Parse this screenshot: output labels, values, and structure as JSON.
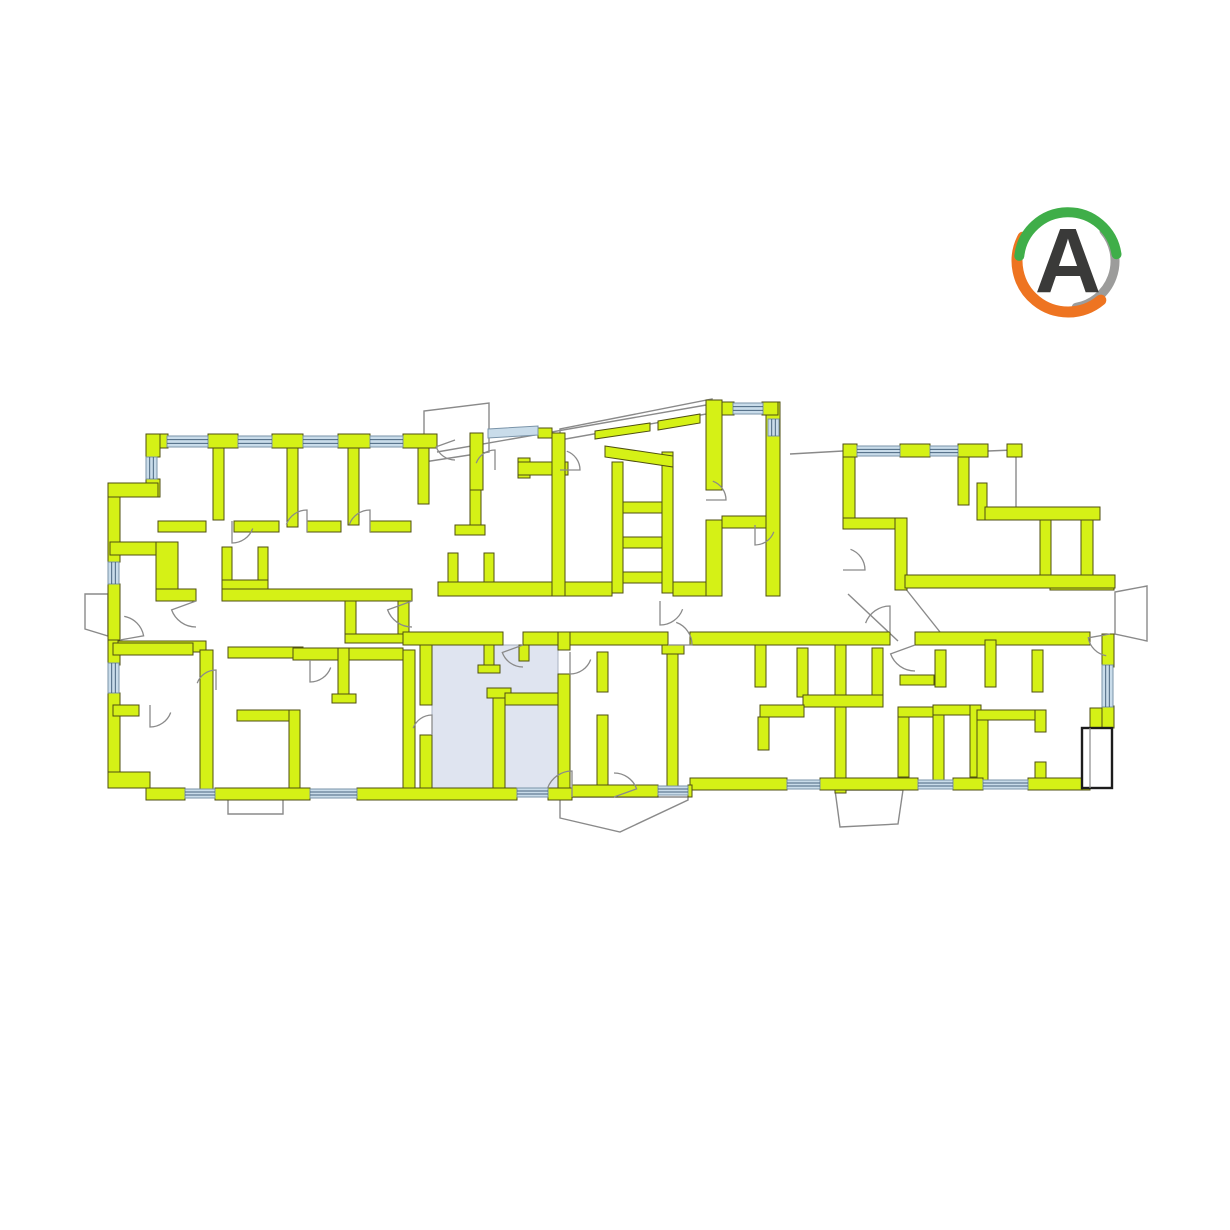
{
  "meta": {
    "background": "#ffffff",
    "width": 1230,
    "height": 1230
  },
  "logo": {
    "letter": "A",
    "letter_color": "#3a3a39",
    "cx": 1068,
    "cy": 261,
    "arcs": [
      {
        "start": -40,
        "end": 80,
        "r": 47,
        "w": 9,
        "color": "#9c9c9b"
      },
      {
        "start": 50,
        "end": 208,
        "r": 51,
        "w": 11,
        "color": "#ee7421"
      },
      {
        "start": 186,
        "end": 352,
        "r": 49,
        "w": 10,
        "color": "#3fae49"
      }
    ]
  },
  "plan": {
    "colors": {
      "wall_fill": "#d5f116",
      "wall_stroke": "#4f4f12",
      "window_fill": "#c9dcea",
      "window_stroke": "#7a93a8",
      "window_line": "#49657e",
      "outline_stroke": "#8a8a8a",
      "door_stroke": "#8a8a8a",
      "highlight_fill": "#dfe4f0",
      "highlight_stroke": "#aab2c2",
      "balcony_stroke": "#1c1c1c"
    },
    "highlight_unit": {
      "rect": [
        432,
        645,
        126,
        143
      ],
      "selected": true
    },
    "balcony": {
      "rect": [
        1082,
        728,
        30,
        60
      ],
      "inner_line": [
        1090,
        728,
        1090,
        788
      ]
    },
    "walls": [
      [
        146,
        434,
        22,
        14
      ],
      [
        208,
        434,
        30,
        14
      ],
      [
        272,
        434,
        31,
        14
      ],
      [
        338,
        434,
        32,
        14
      ],
      [
        403,
        434,
        34,
        14
      ],
      [
        213,
        448,
        11,
        72
      ],
      [
        287,
        448,
        11,
        79
      ],
      [
        348,
        448,
        11,
        77
      ],
      [
        418,
        448,
        11,
        56
      ],
      [
        158,
        521,
        48,
        11
      ],
      [
        234,
        521,
        45,
        11
      ],
      [
        307,
        521,
        34,
        11
      ],
      [
        370,
        521,
        41,
        11
      ],
      [
        146,
        434,
        14,
        23
      ],
      [
        146,
        479,
        14,
        18
      ],
      [
        108,
        483,
        50,
        14
      ],
      [
        108,
        497,
        12,
        65
      ],
      [
        108,
        584,
        12,
        56
      ],
      [
        108,
        640,
        12,
        25
      ],
      [
        108,
        693,
        12,
        80
      ],
      [
        108,
        772,
        42,
        16
      ],
      [
        110,
        542,
        58,
        13
      ],
      [
        156,
        542,
        22,
        47
      ],
      [
        222,
        547,
        10,
        42
      ],
      [
        258,
        547,
        10,
        42
      ],
      [
        222,
        580,
        46,
        9
      ],
      [
        448,
        553,
        10,
        37
      ],
      [
        484,
        553,
        10,
        37
      ],
      [
        448,
        582,
        46,
        8
      ],
      [
        156,
        589,
        40,
        12
      ],
      [
        222,
        589,
        190,
        12
      ],
      [
        438,
        582,
        114,
        14
      ],
      [
        565,
        582,
        47,
        14
      ],
      [
        673,
        582,
        33,
        14
      ],
      [
        345,
        601,
        11,
        40
      ],
      [
        398,
        601,
        11,
        40
      ],
      [
        345,
        634,
        64,
        9
      ],
      [
        470,
        433,
        13,
        57
      ],
      [
        470,
        490,
        11,
        40
      ],
      [
        455,
        525,
        30,
        10
      ],
      [
        518,
        458,
        12,
        20
      ],
      [
        518,
        462,
        50,
        13
      ],
      [
        538,
        428,
        14,
        10
      ],
      [
        552,
        433,
        13,
        163
      ],
      [
        612,
        462,
        11,
        131
      ],
      [
        662,
        452,
        11,
        141
      ],
      [
        623,
        502,
        39,
        11
      ],
      [
        623,
        537,
        39,
        11
      ],
      [
        623,
        572,
        39,
        11
      ],
      [
        706,
        400,
        16,
        90
      ],
      [
        706,
        520,
        16,
        76
      ],
      [
        766,
        402,
        14,
        194
      ],
      [
        722,
        402,
        12,
        13
      ],
      [
        762,
        402,
        16,
        13
      ],
      [
        722,
        516,
        44,
        12
      ],
      [
        843,
        444,
        14,
        13
      ],
      [
        900,
        444,
        30,
        13
      ],
      [
        958,
        444,
        30,
        13
      ],
      [
        1007,
        444,
        15,
        13
      ],
      [
        843,
        457,
        12,
        68
      ],
      [
        843,
        518,
        57,
        11
      ],
      [
        895,
        518,
        12,
        72
      ],
      [
        958,
        457,
        11,
        48
      ],
      [
        977,
        483,
        10,
        37
      ],
      [
        985,
        507,
        115,
        13
      ],
      [
        1040,
        520,
        11,
        57
      ],
      [
        1081,
        520,
        12,
        58
      ],
      [
        1050,
        577,
        64,
        13
      ],
      [
        905,
        575,
        210,
        13
      ],
      [
        118,
        641,
        88,
        11
      ],
      [
        228,
        647,
        75,
        11
      ],
      [
        293,
        648,
        110,
        12
      ],
      [
        403,
        632,
        100,
        13
      ],
      [
        523,
        632,
        145,
        13
      ],
      [
        690,
        632,
        200,
        13
      ],
      [
        915,
        632,
        175,
        13
      ],
      [
        113,
        643,
        80,
        12
      ],
      [
        200,
        650,
        13,
        140
      ],
      [
        113,
        705,
        26,
        11
      ],
      [
        237,
        710,
        63,
        11
      ],
      [
        289,
        710,
        11,
        78
      ],
      [
        338,
        648,
        11,
        50
      ],
      [
        332,
        694,
        24,
        9
      ],
      [
        403,
        650,
        12,
        138
      ],
      [
        420,
        645,
        12,
        60
      ],
      [
        420,
        735,
        12,
        53
      ],
      [
        484,
        645,
        10,
        24
      ],
      [
        478,
        665,
        22,
        8
      ],
      [
        519,
        645,
        10,
        16
      ],
      [
        493,
        688,
        12,
        100
      ],
      [
        487,
        688,
        24,
        10
      ],
      [
        505,
        693,
        55,
        12
      ],
      [
        558,
        632,
        12,
        18
      ],
      [
        558,
        674,
        12,
        114
      ],
      [
        597,
        652,
        11,
        40
      ],
      [
        597,
        715,
        11,
        75
      ],
      [
        667,
        652,
        11,
        138
      ],
      [
        662,
        645,
        22,
        9
      ],
      [
        755,
        645,
        11,
        42
      ],
      [
        797,
        648,
        11,
        49
      ],
      [
        835,
        645,
        11,
        148
      ],
      [
        803,
        695,
        80,
        12
      ],
      [
        872,
        648,
        11,
        47
      ],
      [
        760,
        705,
        44,
        12
      ],
      [
        758,
        717,
        11,
        33
      ],
      [
        898,
        707,
        11,
        70
      ],
      [
        898,
        707,
        46,
        10
      ],
      [
        933,
        705,
        47,
        10
      ],
      [
        970,
        705,
        11,
        72
      ],
      [
        933,
        715,
        11,
        72
      ],
      [
        900,
        675,
        34,
        10
      ],
      [
        935,
        650,
        11,
        37
      ],
      [
        985,
        640,
        11,
        47
      ],
      [
        1032,
        650,
        11,
        42
      ],
      [
        977,
        710,
        11,
        77
      ],
      [
        977,
        710,
        64,
        10
      ],
      [
        1035,
        710,
        11,
        22
      ],
      [
        1035,
        762,
        11,
        25
      ],
      [
        1090,
        708,
        22,
        20
      ],
      [
        1102,
        634,
        12,
        33
      ],
      [
        1102,
        706,
        12,
        22
      ],
      [
        1072,
        780,
        18,
        10
      ],
      [
        690,
        778,
        97,
        12
      ],
      [
        820,
        778,
        98,
        12
      ],
      [
        953,
        778,
        30,
        12
      ],
      [
        1028,
        778,
        54,
        12
      ],
      [
        146,
        788,
        39,
        12
      ],
      [
        215,
        788,
        95,
        12
      ],
      [
        357,
        788,
        160,
        12
      ],
      [
        548,
        788,
        24,
        12
      ],
      [
        572,
        785,
        86,
        12
      ],
      [
        688,
        785,
        4,
        12
      ]
    ],
    "wall_polys": [
      [
        [
          605,
          446
        ],
        [
          673,
          456
        ],
        [
          673,
          467
        ],
        [
          605,
          457
        ]
      ],
      [
        [
          595,
          431
        ],
        [
          650,
          423
        ],
        [
          650,
          431
        ],
        [
          595,
          439
        ]
      ],
      [
        [
          658,
          421
        ],
        [
          700,
          414
        ],
        [
          700,
          423
        ],
        [
          658,
          430
        ]
      ]
    ],
    "roof_outlines": [
      [
        [
          424,
          462
        ],
        [
          424,
          411
        ],
        [
          489,
          403
        ],
        [
          489,
          452
        ]
      ],
      [
        [
          560,
          440
        ],
        [
          560,
          429
        ],
        [
          712,
          399
        ],
        [
          712,
          413
        ]
      ],
      [
        [
          85,
          594
        ],
        [
          108,
          594
        ],
        [
          108,
          636
        ],
        [
          85,
          629
        ]
      ],
      [
        [
          228,
          797
        ],
        [
          283,
          797
        ],
        [
          283,
          814
        ],
        [
          228,
          814
        ]
      ],
      [
        [
          560,
          797
        ],
        [
          688,
          797
        ],
        [
          688,
          800
        ],
        [
          620,
          832
        ],
        [
          560,
          818
        ]
      ],
      [
        [
          835,
          790
        ],
        [
          903,
          790
        ],
        [
          898,
          824
        ],
        [
          840,
          827
        ]
      ],
      [
        [
          1115,
          592
        ],
        [
          1147,
          586
        ],
        [
          1147,
          641
        ],
        [
          1115,
          634
        ]
      ]
    ],
    "windows": [
      [
        167,
        436,
        41,
        11,
        "h"
      ],
      [
        238,
        436,
        34,
        11,
        "h"
      ],
      [
        303,
        436,
        35,
        11,
        "h"
      ],
      [
        370,
        436,
        33,
        11,
        "h"
      ],
      [
        146,
        457,
        11,
        22,
        "v"
      ],
      [
        108,
        562,
        11,
        22,
        "v"
      ],
      [
        108,
        663,
        11,
        30,
        "v"
      ],
      [
        733,
        403,
        30,
        11,
        "h"
      ],
      [
        768,
        419,
        11,
        17,
        "v"
      ],
      [
        857,
        446,
        43,
        10,
        "h"
      ],
      [
        930,
        446,
        28,
        10,
        "h"
      ],
      [
        1102,
        665,
        11,
        42,
        "v"
      ],
      [
        185,
        789,
        30,
        9,
        "h"
      ],
      [
        310,
        789,
        47,
        9,
        "h"
      ],
      [
        517,
        788,
        31,
        9,
        "h"
      ],
      [
        658,
        786,
        30,
        9,
        "h"
      ],
      [
        787,
        780,
        33,
        9,
        "h"
      ],
      [
        918,
        780,
        35,
        9,
        "h"
      ],
      [
        983,
        780,
        45,
        9,
        "h"
      ]
    ],
    "window_polys": [
      [
        [
          488,
          429
        ],
        [
          538,
          426
        ],
        [
          538,
          435
        ],
        [
          488,
          438
        ]
      ]
    ],
    "doors": [
      [
        196,
        601,
        26,
        90,
        160
      ],
      [
        412,
        601,
        26,
        90,
        160
      ],
      [
        660,
        601,
        24,
        20,
        90
      ],
      [
        523,
        645,
        22,
        90,
        160
      ],
      [
        432,
        735,
        20,
        200,
        270
      ],
      [
        570,
        652,
        22,
        20,
        90
      ],
      [
        120,
        640,
        24,
        280,
        350
      ],
      [
        150,
        705,
        22,
        20,
        90
      ],
      [
        216,
        690,
        20,
        200,
        270
      ],
      [
        310,
        660,
        22,
        20,
        90
      ],
      [
        915,
        645,
        26,
        90,
        160
      ],
      [
        890,
        632,
        26,
        200,
        270
      ],
      [
        232,
        521,
        22,
        20,
        90
      ],
      [
        307,
        532,
        22,
        200,
        270
      ],
      [
        370,
        532,
        22,
        200,
        270
      ],
      [
        1110,
        634,
        22,
        100,
        170
      ],
      [
        668,
        645,
        24,
        290,
        360
      ],
      [
        572,
        797,
        26,
        200,
        270
      ],
      [
        614,
        797,
        24,
        270,
        340
      ],
      [
        843,
        570,
        22,
        290,
        360
      ],
      [
        755,
        525,
        20,
        20,
        90
      ],
      [
        706,
        500,
        20,
        290,
        360
      ],
      [
        455,
        440,
        20,
        90,
        160
      ],
      [
        495,
        470,
        20,
        200,
        270
      ],
      [
        560,
        470,
        20,
        290,
        360
      ]
    ],
    "lines": [
      [
        437,
        452,
        712,
        404
      ],
      [
        790,
        454,
        843,
        451
      ],
      [
        988,
        451,
        1013,
        450
      ],
      [
        1016,
        453,
        1016,
        508
      ],
      [
        848,
        594,
        898,
        641
      ],
      [
        905,
        588,
        940,
        632
      ]
    ]
  }
}
